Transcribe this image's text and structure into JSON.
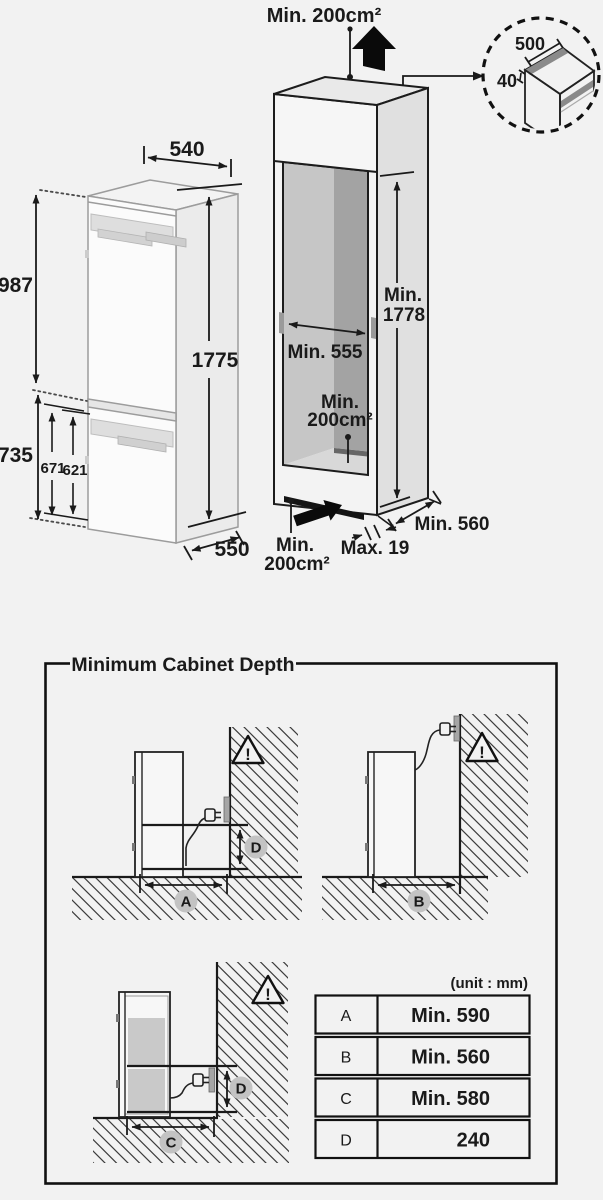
{
  "colors": {
    "background": "#f2f2f2",
    "line": "#1a1a1a",
    "hatch": "#3c3c3c",
    "badge": "#c3c3c3",
    "interior_back": "#a3a3a3",
    "interior_side": "#c6c6c6"
  },
  "top_diagrams": {
    "fridge": {
      "width": "540",
      "upper_height": "987",
      "total_height": "1775",
      "lower_section_height": "735",
      "door_height_1": "671",
      "door_height_2": "621",
      "depth": "550"
    },
    "cabinet": {
      "top_clearance": "Min. 200cm²",
      "height_min": "Min.",
      "height_value": "1778",
      "inner_width": "Min. 555",
      "rear_vent_line1": "Min.",
      "rear_vent_line2": "200cm²",
      "front_vent_line1": "Min.",
      "front_vent_line2": "200cm²",
      "panel_thickness": "Max. 19",
      "depth": "Min. 560"
    },
    "top_detail": {
      "width": "500",
      "depth": "40"
    }
  },
  "cabinet_depth": {
    "title": "Minimum Cabinet Depth",
    "unit": "(unit : mm)",
    "warning": "!",
    "labels": {
      "a": "A",
      "b": "B",
      "c": "C",
      "d": "D"
    },
    "table": {
      "rows": [
        {
          "key": "A",
          "value": "Min. 590"
        },
        {
          "key": "B",
          "value": "Min. 560"
        },
        {
          "key": "C",
          "value": "Min. 580"
        },
        {
          "key": "D",
          "value": "240"
        }
      ]
    }
  }
}
